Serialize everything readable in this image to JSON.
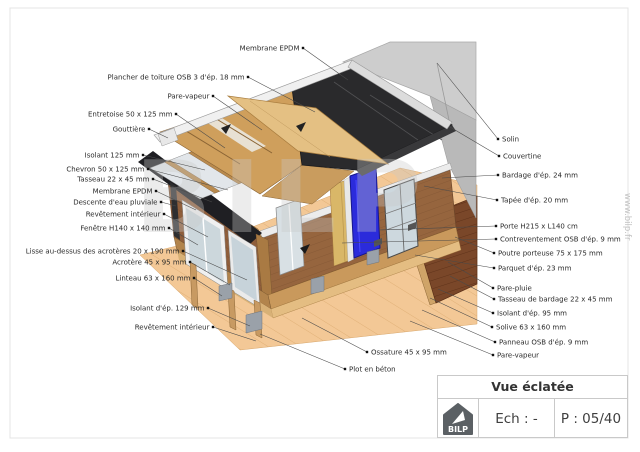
{
  "title_block": {
    "title": "Vue éclatée",
    "scale_label": "Ech : -",
    "page_label": "P : 05/40",
    "logo_text": "BILP"
  },
  "watermark": {
    "text": "BILP"
  },
  "website_vertical_text": "www.bilp.fr",
  "drawing": {
    "description": "Exploded axonometric view of a flat-roof timber-frame extension",
    "colors": {
      "membrane_black": "#2a2a2c",
      "osb_tan": "#cf9f5c",
      "osb_light": "#e4c083",
      "cladding_brown": "#96653e",
      "frame_wood": "#c89a62",
      "door_blue": "#2b2bdb",
      "glass": "#ccd7dc",
      "existing_wall_gray": "#cdcdcd",
      "ground_tan": "#f3c896",
      "deck_brown": "#7a4729",
      "concrete_gray": "#9aa1a9"
    }
  },
  "annotations": [
    {
      "text": "Membrane EPDM",
      "side": "left",
      "dot": [
        303,
        48
      ],
      "target": [
        348,
        80
      ]
    },
    {
      "text": "Plancher de toiture OSB 3 d'ép. 18 mm",
      "side": "left",
      "dot": [
        248,
        77
      ],
      "target": [
        315,
        112
      ]
    },
    {
      "text": "Pare-vapeur",
      "side": "left",
      "dot": [
        213,
        96
      ],
      "target": [
        262,
        130
      ]
    },
    {
      "text": "Entretoise 50 x 125 mm",
      "side": "left",
      "dot": [
        176,
        114
      ],
      "target": [
        225,
        148
      ]
    },
    {
      "text": "Gouttière",
      "side": "left",
      "dot": [
        149,
        129
      ],
      "target": [
        168,
        138
      ]
    },
    {
      "text": "Isolant 125 mm",
      "side": "left",
      "dot": [
        143,
        155
      ],
      "target": [
        205,
        170
      ]
    },
    {
      "text": "Chevron 50 x 125 mm",
      "side": "left",
      "dot": [
        148,
        169
      ],
      "target": [
        228,
        190
      ]
    },
    {
      "text": "Tasseau 22 x 45 mm",
      "side": "left",
      "dot": [
        153,
        179
      ],
      "target": [
        212,
        202
      ]
    },
    {
      "text": "Membrane EPDM",
      "side": "left",
      "dot": [
        156,
        191
      ],
      "target": [
        196,
        210
      ]
    },
    {
      "text": "Descente d'eau pluviale",
      "side": "left",
      "dot": [
        161,
        202
      ],
      "target": [
        176,
        206
      ]
    },
    {
      "text": "Revêtement intérieur",
      "side": "left",
      "dot": [
        164,
        214
      ],
      "target": [
        208,
        237
      ]
    },
    {
      "text": "Fenêtre H140 x 140 mm",
      "side": "left",
      "dot": [
        169,
        228
      ],
      "target": [
        198,
        245
      ]
    },
    {
      "text": "Lisse au-dessus des acrotères 20 x 190 mm",
      "side": "left",
      "dot": [
        183,
        251
      ],
      "target": [
        247,
        280
      ]
    },
    {
      "text": "Acrotère 45 x 95 mm",
      "side": "left",
      "dot": [
        190,
        262
      ],
      "target": [
        230,
        285
      ]
    },
    {
      "text": "Linteau 63 x 160 mm",
      "side": "left",
      "dot": [
        194,
        278
      ],
      "target": [
        222,
        296
      ]
    },
    {
      "text": "Isolant d'ép. 129 mm",
      "side": "left",
      "dot": [
        208,
        308
      ],
      "target": [
        250,
        326
      ]
    },
    {
      "text": "Revêtement intérieur",
      "side": "left",
      "dot": [
        213,
        327
      ],
      "target": [
        256,
        341
      ]
    },
    {
      "text": "Solin",
      "side": "right",
      "dot": [
        498,
        139
      ],
      "target": [
        437,
        63
      ]
    },
    {
      "text": "Couvertine",
      "side": "right",
      "dot": [
        499,
        156
      ],
      "target": [
        450,
        127
      ]
    },
    {
      "text": "Bardage d'ép. 24 mm",
      "side": "right",
      "dot": [
        498,
        175
      ],
      "target": [
        442,
        178
      ]
    },
    {
      "text": "Tapée d'ép. 20 mm",
      "side": "right",
      "dot": [
        497,
        200
      ],
      "target": [
        424,
        186
      ]
    },
    {
      "text": "Porte H215 x L140 cm",
      "side": "right",
      "dot": [
        496,
        226
      ],
      "target": [
        379,
        230
      ]
    },
    {
      "text": "Contreventement OSB d'ép. 9 mm",
      "side": "right",
      "dot": [
        496,
        239
      ],
      "target": [
        342,
        243
      ]
    },
    {
      "text": "Poutre porteuse 75 x 175 mm",
      "side": "right",
      "dot": [
        494,
        253
      ],
      "target": [
        455,
        237
      ]
    },
    {
      "text": "Parquet d'ép. 23 mm",
      "side": "right",
      "dot": [
        494,
        268
      ],
      "target": [
        415,
        255
      ]
    },
    {
      "text": "Pare-pluie",
      "side": "right",
      "dot": [
        493,
        288
      ],
      "target": [
        448,
        262
      ]
    },
    {
      "text": "Tasseau de bardage 22 x 45 mm",
      "side": "right",
      "dot": [
        494,
        299
      ],
      "target": [
        450,
        276
      ]
    },
    {
      "text": "Isolant d'ép. 95 mm",
      "side": "right",
      "dot": [
        493,
        313
      ],
      "target": [
        438,
        289
      ]
    },
    {
      "text": "Solive 63 x 160 mm",
      "side": "right",
      "dot": [
        492,
        327
      ],
      "target": [
        430,
        298
      ]
    },
    {
      "text": "Panneau OSB d'ép. 9 mm",
      "side": "right",
      "dot": [
        495,
        342
      ],
      "target": [
        422,
        310
      ]
    },
    {
      "text": "Pare-vapeur",
      "side": "right",
      "dot": [
        493,
        355
      ],
      "target": [
        410,
        321
      ]
    },
    {
      "text": "Ossature 45 x 95 mm",
      "side": "right",
      "dot": [
        367,
        352
      ],
      "target": [
        302,
        318
      ]
    },
    {
      "text": "Plot en béton",
      "side": "right",
      "dot": [
        345,
        369
      ],
      "target": [
        260,
        334
      ]
    }
  ]
}
